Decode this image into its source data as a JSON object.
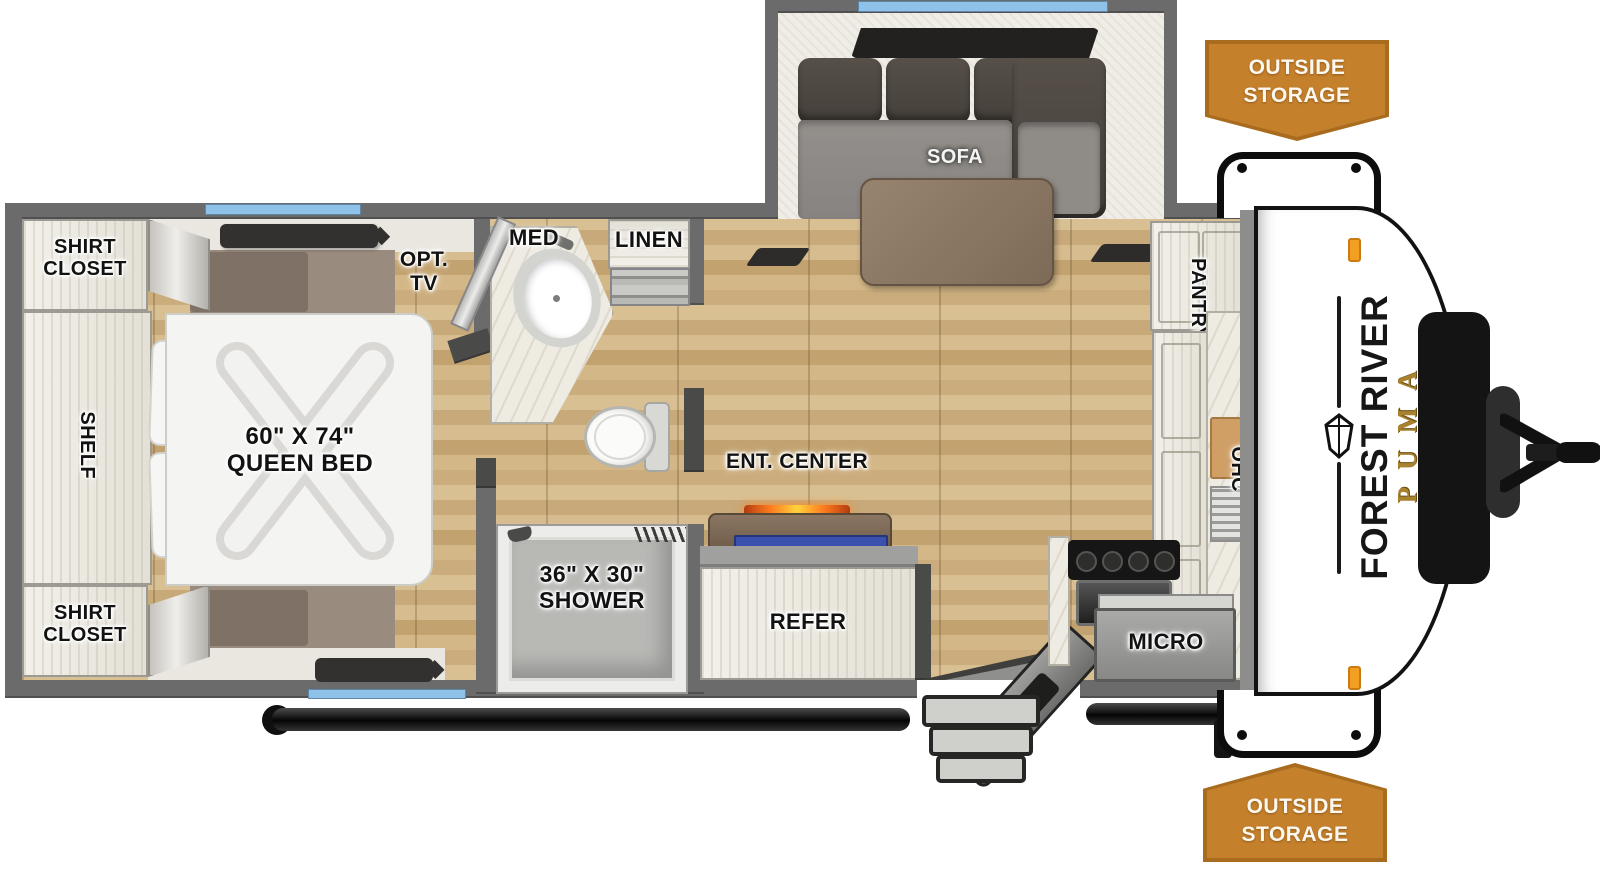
{
  "title": "Forest River Puma travel trailer floorplan (top view)",
  "brand": {
    "maker": "FOREST RIVER",
    "model": "PUMA"
  },
  "badges": {
    "line1": "OUTSIDE",
    "line2": "STORAGE"
  },
  "labels": {
    "sofa": "SOFA",
    "shirt_closet_line1": "SHIRT",
    "shirt_closet_line2": "CLOSET",
    "shelf": "SHELF",
    "opt_tv_line1": "OPT.",
    "opt_tv_line2": "TV",
    "bed_line1": "60\" X 74\"",
    "bed_line2": "QUEEN BED",
    "med": "MED",
    "linen": "LINEN",
    "shower_line1": "36\" X 30\"",
    "shower_line2": "SHOWER",
    "ent_center": "ENT. CENTER",
    "refer": "REFER",
    "pantry": "PANTRY",
    "ohc": "OHC",
    "micro": "MICRO"
  },
  "colors": {
    "badge_orange": "#c5802c",
    "badge_border": "#a96c1e",
    "wall_gray": "#6b6b6b",
    "floor_wood": "#cfb183",
    "window_blue": "#8ec2e8",
    "puma_gold": "#a8822f",
    "fireplace_orange": "#ff7c1f",
    "tv_blue": "#3a52ad"
  }
}
